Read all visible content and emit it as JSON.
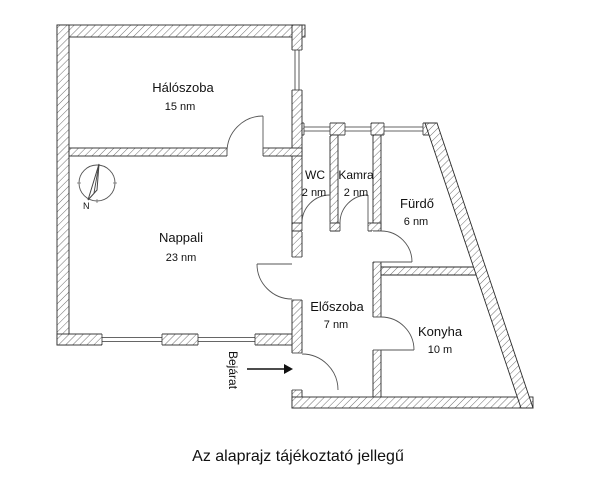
{
  "floorplan": {
    "rooms": {
      "haloszoba": {
        "name": "Hálószoba",
        "area": "15 nm"
      },
      "nappali": {
        "name": "Nappali",
        "area": "23 nm"
      },
      "wc": {
        "name": "WC",
        "area": "2 nm"
      },
      "kamra": {
        "name": "Kamra",
        "area": "2 nm"
      },
      "furdo": {
        "name": "Fürdő",
        "area": "6 nm"
      },
      "eloszoba": {
        "name": "Előszoba",
        "area": "7 nm"
      },
      "konyha": {
        "name": "Konyha",
        "area": "10 m"
      }
    },
    "entrance": {
      "label": "Bejárat"
    },
    "compass": {
      "label": "N"
    },
    "caption": "Az alaprajz tájékoztató jellegű"
  },
  "colors": {
    "background": "#ffffff",
    "wall_outline": "#2b2b2b",
    "wall_hatch": "#6e6e6e",
    "door_line": "#555555",
    "text": "#111111"
  }
}
